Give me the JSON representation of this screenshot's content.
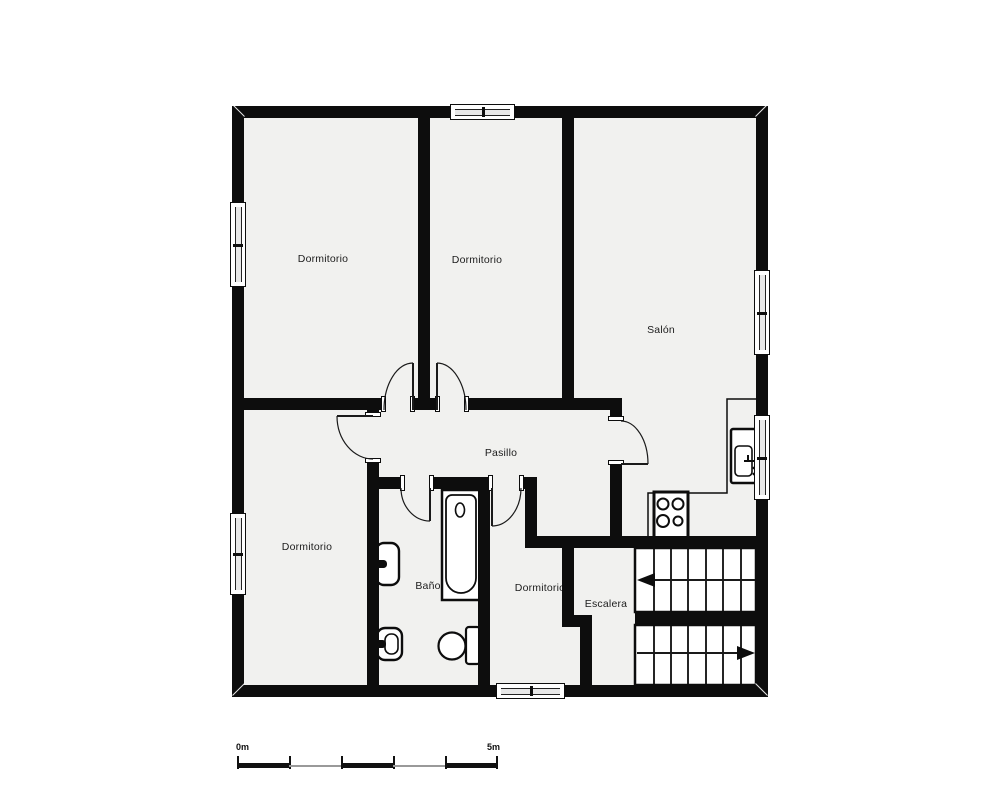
{
  "plan": {
    "type": "floor-plan",
    "rooms": {
      "bedroom_top_left": {
        "label": "Dormitorio"
      },
      "bedroom_top_middle": {
        "label": "Dormitorio"
      },
      "living_room": {
        "label": "Salón"
      },
      "hallway": {
        "label": "Pasillo"
      },
      "bedroom_bottom_left": {
        "label": "Dormitorio"
      },
      "bathroom": {
        "label": "Baño"
      },
      "bedroom_bottom_middle": {
        "label": "Dormitorio"
      },
      "stairs": {
        "label": "Escalera"
      }
    },
    "fixtures": [
      "bathtub",
      "washbasin",
      "bidet",
      "toilet",
      "stove",
      "kitchen-sink",
      "stairs-up-flight",
      "stairs-down-flight",
      "kitchen-counter"
    ],
    "scale_bar": {
      "start_label": "0m",
      "end_label": "5m"
    },
    "colors": {
      "wall": "#0d0d0d",
      "floor": "#f1f1ef",
      "background": "#ffffff",
      "scale_gray": "#999999"
    }
  }
}
